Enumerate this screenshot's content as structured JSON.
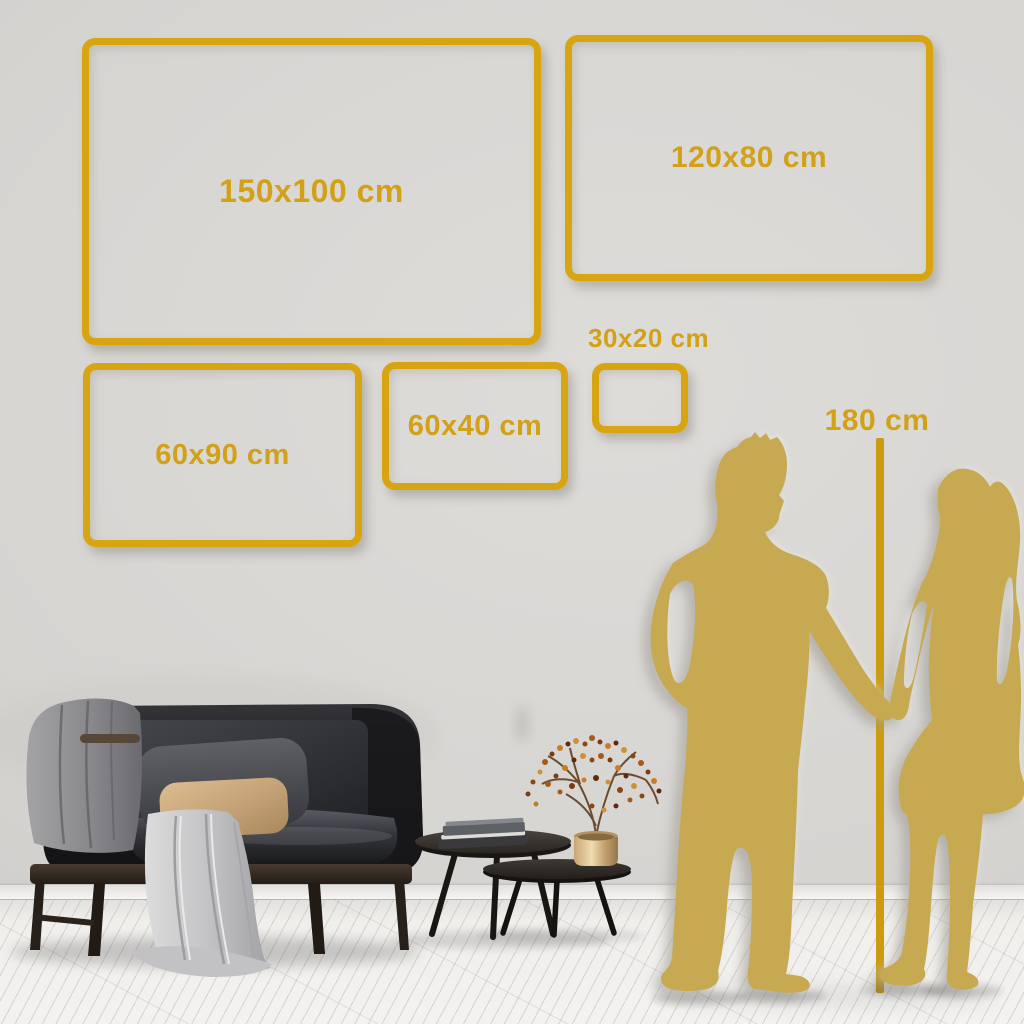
{
  "size_guide": {
    "frames": [
      {
        "id": "150x100",
        "label": "150x100 cm"
      },
      {
        "id": "120x80",
        "label": "120x80 cm"
      },
      {
        "id": "60x90",
        "label": "60x90 cm"
      },
      {
        "id": "60x40",
        "label": "60x40 cm"
      },
      {
        "id": "30x20",
        "label": "30x20 cm"
      }
    ],
    "height_reference": {
      "label": "180 cm"
    }
  },
  "colors": {
    "frame_gold": "#D7A512",
    "label_gold": "#D2A117",
    "silhouette_gold": "#C7A952",
    "marker_line_gold": "#CB9C12",
    "wall": "#D8D6D3",
    "floor": "#F1EFEC"
  },
  "scene": {
    "items": [
      "dark-sofa",
      "gray-throw-blanket",
      "dark-gray-pillow",
      "tan-pillow",
      "nesting-coffee-tables",
      "book-stack",
      "brass-vase-berry-branch",
      "man-silhouette",
      "woman-silhouette",
      "height-marker-line"
    ]
  }
}
